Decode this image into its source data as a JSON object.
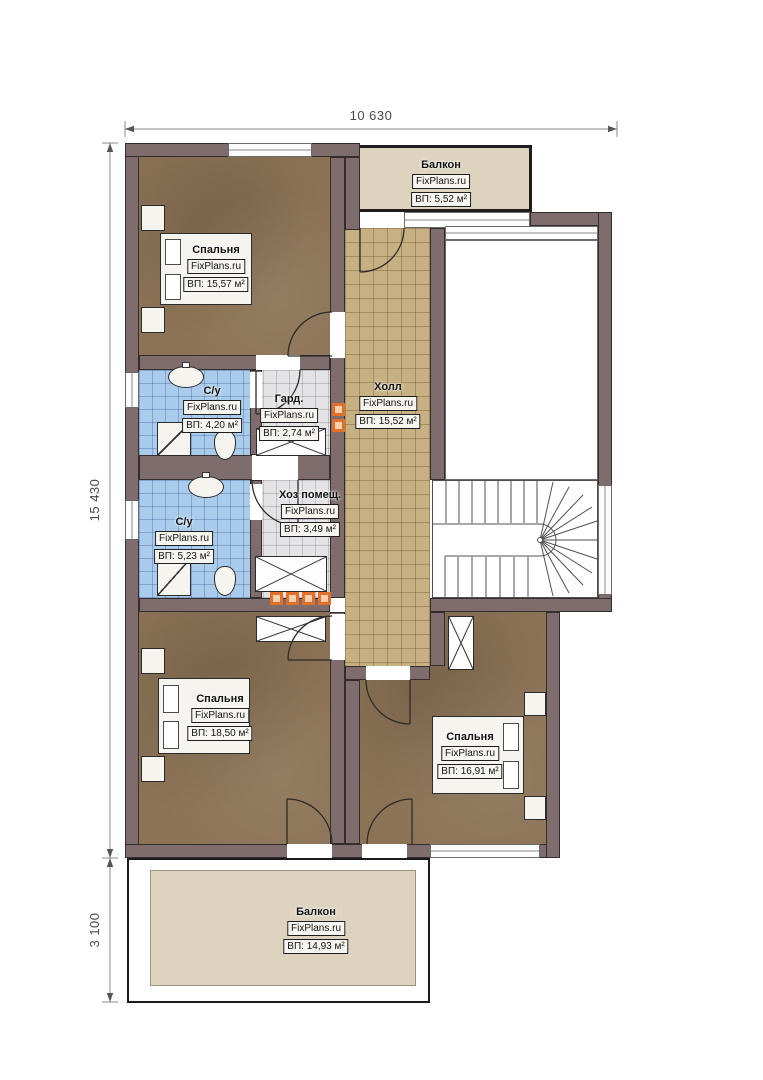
{
  "title": "Floor plan — second storey",
  "watermark": "FixPlans.ru",
  "dimensions": {
    "top": "10 630",
    "left": "15 430",
    "bottom_left": "3 100"
  },
  "rooms": [
    {
      "id": "bedroom-1",
      "name": "Спальня",
      "area": "ВП: 15,57 м²"
    },
    {
      "id": "balcony-top",
      "name": "Балкон",
      "area": "ВП: 5,52 м²"
    },
    {
      "id": "bathroom-1",
      "name": "С/у",
      "area": "ВП: 4,20 м²"
    },
    {
      "id": "wardrobe",
      "name": "Гард.",
      "area": "ВП: 2,74 м²"
    },
    {
      "id": "hall",
      "name": "Холл",
      "area": "ВП: 15,52 м²"
    },
    {
      "id": "utility-room",
      "name": "Хоз помещ.",
      "area": "ВП: 3,49 м²"
    },
    {
      "id": "bathroom-2",
      "name": "С/у",
      "area": "ВП: 5,23 м²"
    },
    {
      "id": "bedroom-2",
      "name": "Спальня",
      "area": "ВП: 18,50 м²"
    },
    {
      "id": "bedroom-3",
      "name": "Спальня",
      "area": "ВП: 16,91 м²"
    },
    {
      "id": "balcony-bottom",
      "name": "Балкон",
      "area": "ВП: 14,93 м²"
    }
  ],
  "colors": {
    "wall": "#7f6c6c",
    "bedroom_floor": "#8c7356",
    "hall_tile": "#c7b183",
    "bath_tile": "#a9cbec",
    "balcony_floor": "#ddd3bf",
    "vent_accent": "#e2702a"
  }
}
